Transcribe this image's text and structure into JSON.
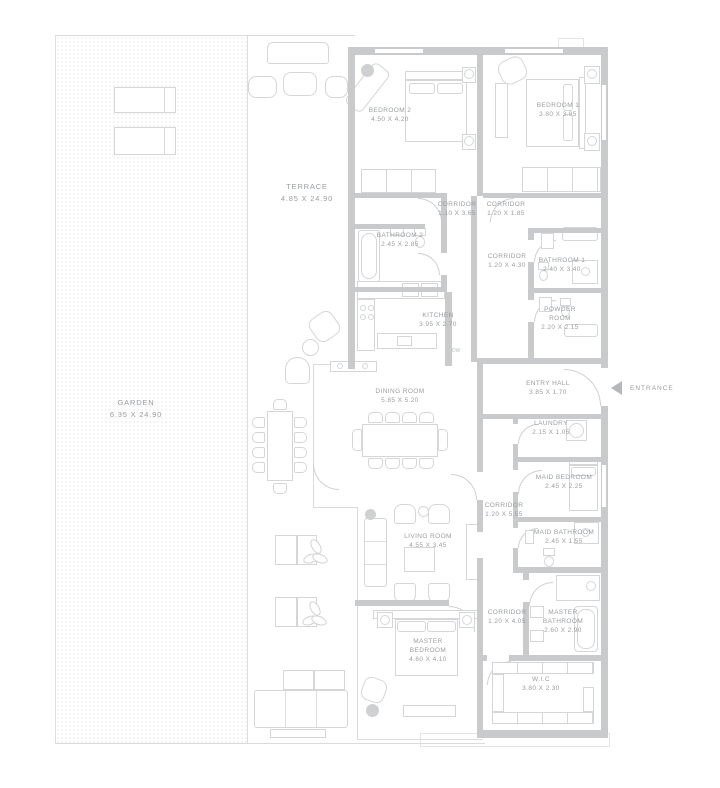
{
  "colors": {
    "wall": "#c9cacc",
    "furniture_line": "#d4d6d8",
    "label_text": "#9a9ea1",
    "entrance_arrow": "#b5b8bb"
  },
  "entrance": {
    "label": "ENTRANCE"
  },
  "annotations": {
    "dishwasher": "DW"
  },
  "rooms": [
    {
      "id": "garden",
      "name": "GARDEN",
      "dims": "6.35 X 24.90"
    },
    {
      "id": "terrace",
      "name": "TERRACE",
      "dims": "4.85 X 24.90"
    },
    {
      "id": "bedroom-2",
      "name": "BEDROOM 2",
      "dims": "4.50 X 4.20"
    },
    {
      "id": "bedroom-1",
      "name": "BEDROOM 1",
      "dims": "3.80 X 3.95"
    },
    {
      "id": "corridor-a",
      "name": "CORRIDOR",
      "dims": "1.10 X 3.65"
    },
    {
      "id": "corridor-b",
      "name": "CORRIDOR",
      "dims": "1.20 X 1.85"
    },
    {
      "id": "bathroom-2",
      "name": "BATHROOM 2",
      "dims": "2.45 X 2.85"
    },
    {
      "id": "corridor-c",
      "name": "CORRIDOR",
      "dims": "1.20 X 4.30"
    },
    {
      "id": "bathroom-1",
      "name": "BATHROOM 1",
      "dims": "2.40 X 3.40"
    },
    {
      "id": "kitchen",
      "name": "KITCHEN",
      "dims": "3.95 X 2.70"
    },
    {
      "id": "powder-room",
      "name": "POWDER ROOM",
      "dims": "2.20 X 2.15"
    },
    {
      "id": "entry-hall",
      "name": "ENTRY HALL",
      "dims": "3.85 X 1.70"
    },
    {
      "id": "dining-room",
      "name": "DINING ROOM",
      "dims": "5.85 X 5.20"
    },
    {
      "id": "laundry",
      "name": "LAUNDRY",
      "dims": "2.15 X 1.05"
    },
    {
      "id": "maid-bedroom",
      "name": "MAID BEDROOM",
      "dims": "2.45 X 2.25"
    },
    {
      "id": "corridor-d",
      "name": "CORRIDOR",
      "dims": "1.20 X 5.55"
    },
    {
      "id": "maid-bathroom",
      "name": "MAID BATHROOM",
      "dims": "2.45 X 1.55"
    },
    {
      "id": "living-room",
      "name": "LIVING ROOM",
      "dims": "4.55 X 3.45"
    },
    {
      "id": "corridor-e",
      "name": "CORRIDOR",
      "dims": "1.20 X 4.05"
    },
    {
      "id": "master-bathroom",
      "name": "MASTER BATHROOM",
      "dims": "2.60 X 2.90"
    },
    {
      "id": "master-bedroom",
      "name": "MASTER BEDROOM",
      "dims": "4.60 X 4.10"
    },
    {
      "id": "wic",
      "name": "W.I.C",
      "dims": "3.80 X 2.30"
    }
  ]
}
